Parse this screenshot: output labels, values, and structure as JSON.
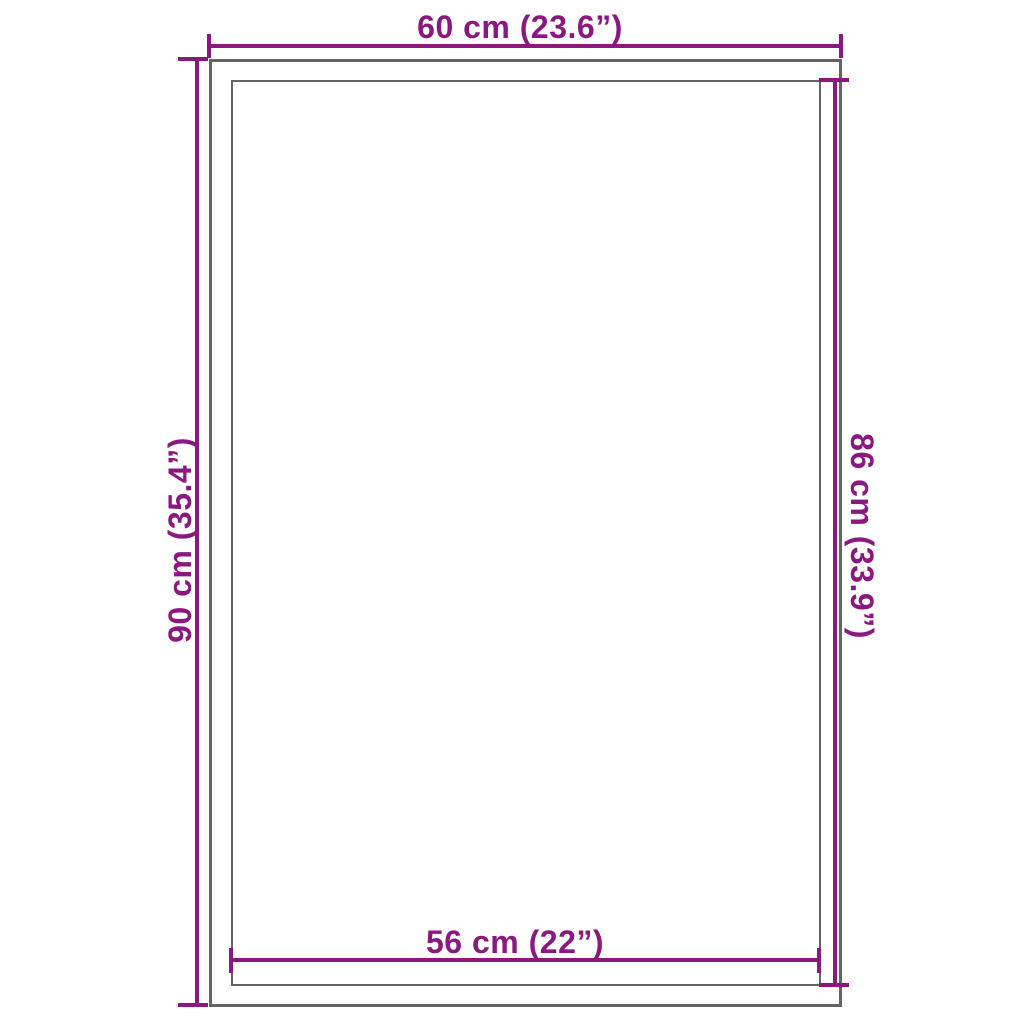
{
  "colors": {
    "dimension": "#8B1781",
    "outline": "#646464",
    "background": "#FFFFFF"
  },
  "dimensions": {
    "top": {
      "label": "60 cm (23.6”)"
    },
    "left": {
      "label": "90 cm (35.4”)"
    },
    "right": {
      "label": "86 cm (33.9”)"
    },
    "bottom": {
      "label": "56 cm (22”)"
    }
  }
}
